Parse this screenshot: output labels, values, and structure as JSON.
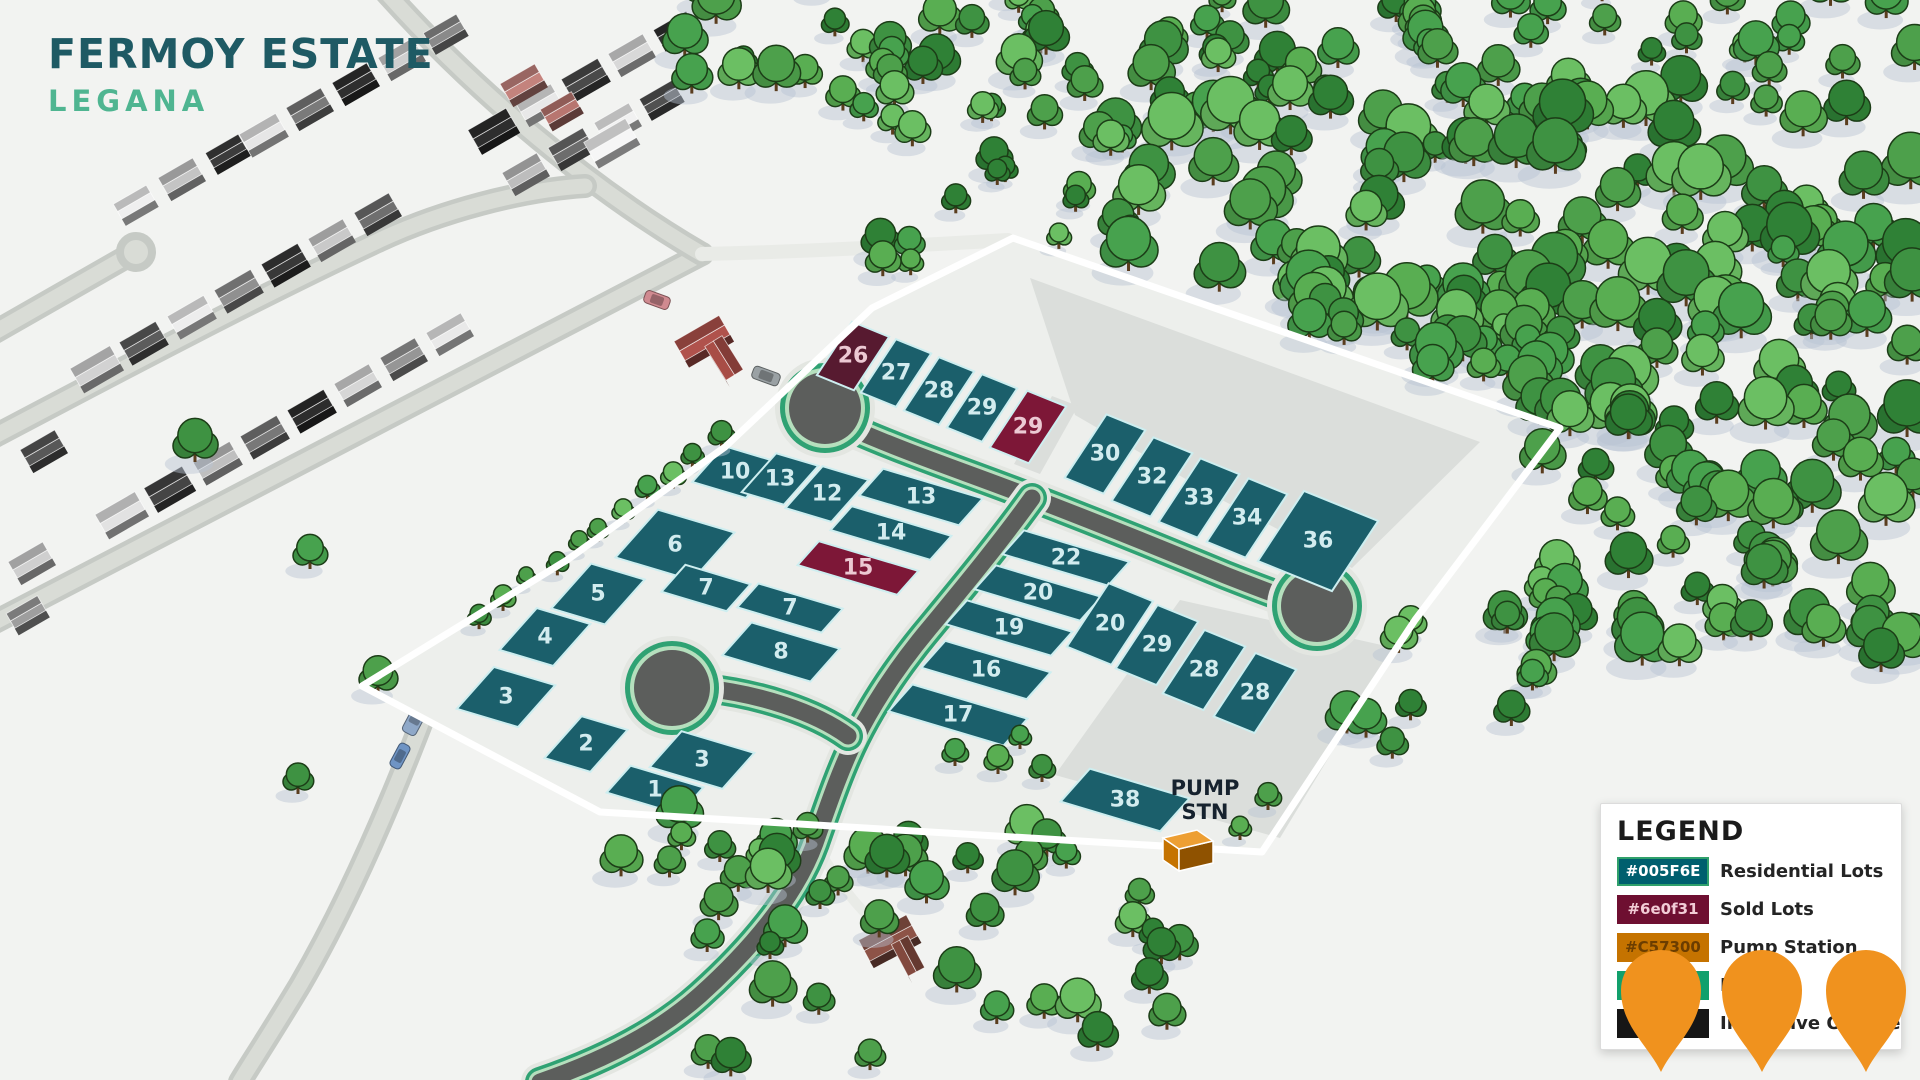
{
  "app": {
    "title": "FERMOY ESTATE",
    "subtitle": "LEGANA"
  },
  "legend": {
    "title": "LEGEND",
    "rows": [
      {
        "swatch_color": "#005F6E",
        "swatch_text": "#005F6E",
        "swatch_text_color": "#ffffff",
        "swatch_border": "#2fa06b",
        "label": "Residential Lots"
      },
      {
        "swatch_color": "#6e0f31",
        "swatch_text": "#6e0f31",
        "swatch_text_color": "#f2ccd6",
        "swatch_border": "#6e0f31",
        "label": "Sold Lots"
      },
      {
        "swatch_color": "#C57300",
        "swatch_text": "#C57300",
        "swatch_text_color": "#6b3d00",
        "swatch_border": "#C57300",
        "label": "Pump Station"
      },
      {
        "swatch_color": "#11a06c",
        "swatch_text": "",
        "swatch_text_color": "#ffffff",
        "swatch_border": "#11a06c",
        "label": "Roads"
      },
      {
        "swatch_color": "#161616",
        "swatch_text": "",
        "swatch_text_color": "#ffffff",
        "swatch_border": "#161616",
        "label": "Indicative Outline"
      }
    ]
  },
  "pump_station": {
    "line1": "PUMP",
    "line2": "STN"
  },
  "map": {
    "colors": {
      "residential": "#1b5f6b",
      "residential_label": "#d2ecef",
      "sold": "#7d1737",
      "sold_dark": "#571a30",
      "sold_label": "#ecc9d3",
      "lot_line": "#cdeef0",
      "outline": "#ffffff",
      "asphalt": "#5c5e5c",
      "verge_green": "#2fa273",
      "verge_light": "#b5dfbd",
      "concrete": "#e3e6e1",
      "suburb_road": "#c6cac5",
      "suburb_road_center": "#d9dcd6",
      "estate_fill": "#edefec",
      "open_gray": "#dbdedb",
      "pin": "#F0921E",
      "pump_top": "#ED9F33",
      "pump_front": "#C57300",
      "pump_side": "#8f5200",
      "pump_label_color": "#16222e"
    },
    "boundary": [
      [
        362,
        686
      ],
      [
        567,
        560
      ],
      [
        725,
        447
      ],
      [
        872,
        308
      ],
      [
        1013,
        238
      ],
      [
        1560,
        428
      ],
      [
        1415,
        620
      ],
      [
        1262,
        852
      ],
      [
        600,
        812
      ]
    ],
    "gray_areas": [
      [
        [
          1030,
          278
        ],
        [
          1480,
          442
        ],
        [
          1352,
          568
        ],
        [
          1222,
          500
        ],
        [
          1075,
          415
        ]
      ],
      [
        [
          1180,
          600
        ],
        [
          1395,
          648
        ],
        [
          1280,
          838
        ],
        [
          1055,
          775
        ]
      ],
      [
        [
          1052,
          396
        ],
        [
          1078,
          406
        ],
        [
          1040,
          474
        ],
        [
          1014,
          464
        ]
      ]
    ],
    "lots": [
      {
        "n": "26",
        "x": 853,
        "y": 356,
        "a": 20,
        "b": 32,
        "ax": "T",
        "type": "sold",
        "fill": "#571a30"
      },
      {
        "n": "27",
        "x": 896,
        "y": 373,
        "a": 19,
        "b": 32,
        "ax": "T",
        "type": "res"
      },
      {
        "n": "28",
        "x": 939,
        "y": 391,
        "a": 19,
        "b": 32,
        "ax": "T",
        "type": "res"
      },
      {
        "n": "29",
        "x": 982,
        "y": 408,
        "a": 19,
        "b": 32,
        "ax": "T",
        "type": "res"
      },
      {
        "n": "29",
        "x": 1028,
        "y": 427,
        "a": 21,
        "b": 34,
        "ax": "T",
        "type": "sold"
      },
      {
        "n": "30",
        "x": 1105,
        "y": 454,
        "a": 21,
        "b": 38,
        "ax": "T",
        "type": "res"
      },
      {
        "n": "32",
        "x": 1152,
        "y": 477,
        "a": 21,
        "b": 38,
        "ax": "T",
        "type": "res"
      },
      {
        "n": "33",
        "x": 1199,
        "y": 498,
        "a": 21,
        "b": 38,
        "ax": "T",
        "type": "res"
      },
      {
        "n": "34",
        "x": 1247,
        "y": 518,
        "a": 21,
        "b": 38,
        "ax": "T",
        "type": "res"
      },
      {
        "n": "36",
        "x": 1318,
        "y": 541,
        "a": 40,
        "b": 42,
        "ax": "T",
        "type": "res"
      },
      {
        "n": "10",
        "x": 735,
        "y": 472,
        "a": 28,
        "b": 24,
        "ax": "W",
        "type": "res"
      },
      {
        "n": "13",
        "x": 780,
        "y": 479,
        "a": 22,
        "b": 26,
        "ax": "W",
        "type": "res"
      },
      {
        "n": "12",
        "x": 827,
        "y": 494,
        "a": 24,
        "b": 28,
        "ax": "W",
        "type": "res"
      },
      {
        "n": "13",
        "x": 921,
        "y": 497,
        "a": 52,
        "b": 18,
        "ax": "W",
        "type": "res"
      },
      {
        "n": "14",
        "x": 891,
        "y": 533,
        "a": 52,
        "b": 16,
        "ax": "W",
        "type": "res"
      },
      {
        "n": "15",
        "x": 858,
        "y": 568,
        "a": 52,
        "b": 16,
        "ax": "W",
        "type": "sold"
      },
      {
        "n": "6",
        "x": 675,
        "y": 545,
        "a": 40,
        "b": 32,
        "ax": "W",
        "type": "res"
      },
      {
        "n": "7",
        "x": 706,
        "y": 588,
        "a": 34,
        "b": 18,
        "ax": "W",
        "type": "res"
      },
      {
        "n": "7",
        "x": 790,
        "y": 608,
        "a": 44,
        "b": 16,
        "ax": "W",
        "type": "res"
      },
      {
        "n": "8",
        "x": 781,
        "y": 652,
        "a": 46,
        "b": 22,
        "ax": "W",
        "type": "res"
      },
      {
        "n": "5",
        "x": 598,
        "y": 594,
        "a": 28,
        "b": 30,
        "ax": "W",
        "type": "res"
      },
      {
        "n": "4",
        "x": 545,
        "y": 637,
        "a": 28,
        "b": 28,
        "ax": "W",
        "type": "res"
      },
      {
        "n": "3",
        "x": 506,
        "y": 697,
        "a": 32,
        "b": 28,
        "ax": "W",
        "type": "res"
      },
      {
        "n": "2",
        "x": 586,
        "y": 744,
        "a": 24,
        "b": 28,
        "ax": "W",
        "type": "res"
      },
      {
        "n": "3",
        "x": 702,
        "y": 760,
        "a": 38,
        "b": 24,
        "ax": "W",
        "type": "res"
      },
      {
        "n": "1",
        "x": 655,
        "y": 790,
        "a": 38,
        "b": 18,
        "ax": "W",
        "type": "res"
      },
      {
        "n": "22",
        "x": 1066,
        "y": 558,
        "a": 55,
        "b": 16,
        "ax": "W",
        "type": "res"
      },
      {
        "n": "20",
        "x": 1038,
        "y": 593,
        "a": 55,
        "b": 16,
        "ax": "W",
        "type": "res"
      },
      {
        "n": "19",
        "x": 1009,
        "y": 628,
        "a": 55,
        "b": 16,
        "ax": "W",
        "type": "res"
      },
      {
        "n": "16",
        "x": 986,
        "y": 670,
        "a": 55,
        "b": 18,
        "ax": "W",
        "type": "res"
      },
      {
        "n": "17",
        "x": 958,
        "y": 715,
        "a": 60,
        "b": 18,
        "ax": "W",
        "type": "res"
      },
      {
        "n": "20",
        "x": 1110,
        "y": 624,
        "a": 24,
        "b": 38,
        "ax": "T",
        "type": "res"
      },
      {
        "n": "29",
        "x": 1157,
        "y": 645,
        "a": 22,
        "b": 38,
        "ax": "T",
        "type": "res"
      },
      {
        "n": "28",
        "x": 1204,
        "y": 670,
        "a": 22,
        "b": 38,
        "ax": "T",
        "type": "res"
      },
      {
        "n": "28",
        "x": 1255,
        "y": 693,
        "a": 22,
        "b": 38,
        "ax": "T",
        "type": "res"
      },
      {
        "n": "38",
        "x": 1125,
        "y": 800,
        "a": 52,
        "b": 22,
        "ax": "W",
        "type": "res"
      }
    ],
    "roads": {
      "main_ew": "M 851 428 C 905 452 965 472 1025 495 C 1085 518 1160 548 1225 575 C 1258 588 1282 597 1300 603",
      "branch_s": "M 1032 498 C 1002 540 965 585 932 625 C 900 663 875 700 856 738 C 840 770 828 806 815 843 C 795 898 748 952 700 995 C 652 1038 590 1065 540 1082",
      "stem_w": "M 704 688 C 760 694 815 712 848 736",
      "bulbs": [
        [
          825,
          408,
          36
        ],
        [
          672,
          688,
          38
        ],
        [
          1317,
          606,
          36
        ]
      ]
    },
    "pump": {
      "tx": 1205,
      "ty": 795,
      "bx": 1185,
      "by": 832
    },
    "pins": [
      [
        1661,
        988
      ],
      [
        1762,
        988
      ],
      [
        1866,
        988
      ]
    ]
  }
}
